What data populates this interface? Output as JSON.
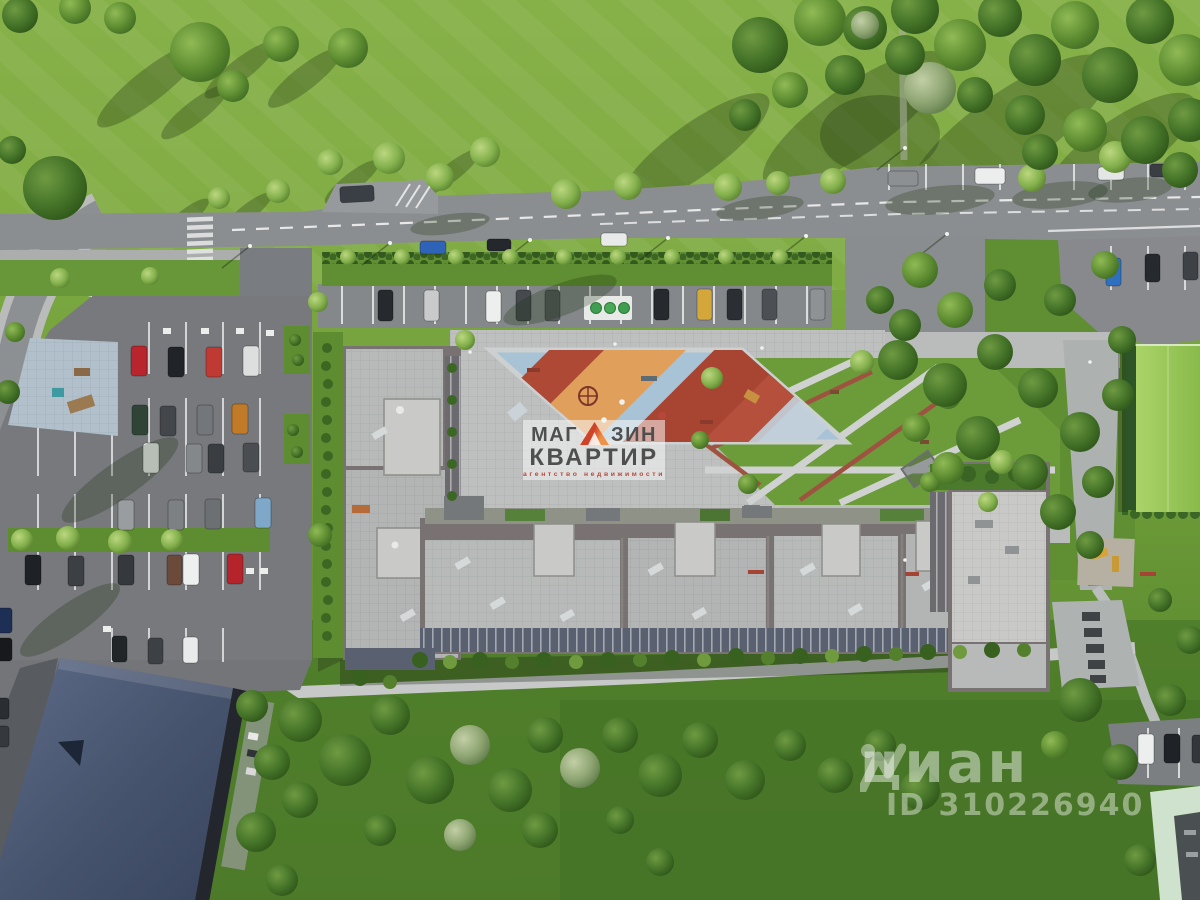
{
  "scene": {
    "aria_label": "Aerial top-down 3D render of a residential complex site plan with parking lots, courtyard playground, park greenery and surrounding roads"
  },
  "watermark_agency": {
    "line1_left": "МАГ",
    "line1_right": "ЗИН",
    "triangle_icon": "roof-triangle-icon",
    "line2": "КВАРТИР",
    "tagline": "агентство недвижимости"
  },
  "watermark_cian": {
    "logo_icon": "cian-person-icon",
    "brand": "циан",
    "listing_id": "ID 310226940"
  },
  "colors": {
    "grass_top": "#85ae47",
    "grass_mid": "#6f9e3a",
    "grass_dark": "#4f7d2b",
    "road": "#8b8e90",
    "asphalt": "#797c80",
    "paver": "#bdc0bf",
    "roof": "#b7bab9",
    "roof_light": "#c9cac7",
    "facade": "#787272",
    "balcony": "#596070",
    "slate_roof": "#4e5b77",
    "lime_roof": "#9cc95c",
    "mint_roof": "#cfe2cd",
    "playground_blue": "#a9c3d6",
    "playground_red": "#ae4936",
    "playground_orange": "#e0a05c",
    "wm_text": "#4f4f4f",
    "wm_red": "#b5483a",
    "wm_tri_dark": "#cf4428",
    "wm_tri_light": "#ef9146",
    "cian_white": "rgba(255,255,255,0.45)"
  }
}
